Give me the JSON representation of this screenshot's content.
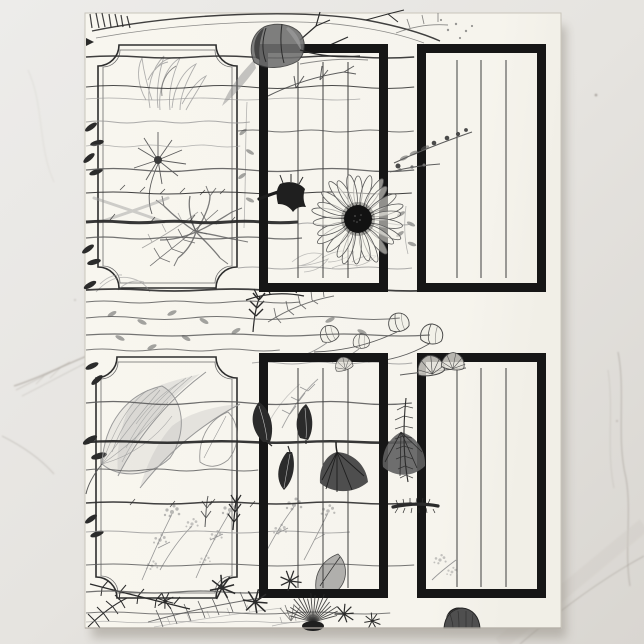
{
  "scene": {
    "type": "product-photo",
    "surface": "white-marble",
    "product": "botanical-journal-page"
  },
  "colors": {
    "marble_base": "#eae8e4",
    "marble_dark": "#d9d6d1",
    "marble_vein": "#a39d95",
    "paper": "#f7f5ee",
    "paper_edge": "#c9c5bb",
    "shadow": "#9a948b",
    "ink": "#161616",
    "ink_dark": "#2b2b2b",
    "sketch_mid": "#5c5c5c",
    "sketch_light": "#979797",
    "rule_line": "#3f3f3f"
  },
  "paper": {
    "x": 85,
    "y": 13,
    "width": 476,
    "height": 615
  },
  "frames": {
    "ornate": [
      {
        "id": "top-left-label",
        "x": 98,
        "y": 45,
        "w": 139,
        "h": 243,
        "r": 21
      },
      {
        "id": "bottom-left-label",
        "x": 96,
        "y": 357,
        "w": 141,
        "h": 241,
        "r": 21
      }
    ],
    "journal": [
      {
        "id": "top-middle",
        "x": 259,
        "y": 44,
        "w": 129,
        "h": 248,
        "stroke": 9,
        "line_xs": [
          298,
          323,
          348
        ],
        "line_y1": 62,
        "line_y2": 278
      },
      {
        "id": "top-right",
        "x": 417,
        "y": 44,
        "w": 129,
        "h": 248,
        "stroke": 9,
        "line_xs": [
          457,
          481,
          506
        ],
        "line_y1": 60,
        "line_y2": 278
      },
      {
        "id": "bottom-middle",
        "x": 259,
        "y": 353,
        "w": 129,
        "h": 245,
        "stroke": 9,
        "line_xs": [
          298,
          323,
          348
        ],
        "line_y1": 368,
        "line_y2": 588
      },
      {
        "id": "bottom-right",
        "x": 417,
        "y": 353,
        "w": 129,
        "h": 245,
        "stroke": 9,
        "line_xs": [
          457,
          481,
          506
        ],
        "line_y1": 368,
        "line_y2": 587
      }
    ]
  },
  "stems": [
    {
      "y": 57,
      "x1": 86,
      "x2": 414,
      "w": 1.5,
      "tone": "dark",
      "amp": 2,
      "o": 0.9
    },
    {
      "y": 87,
      "x1": 86,
      "x2": 414,
      "w": 1.1,
      "tone": "dark",
      "amp": 3,
      "o": 0.85
    },
    {
      "y": 99,
      "x1": 86,
      "x2": 360,
      "w": 0.8,
      "tone": "light",
      "amp": 2,
      "o": 0.8
    },
    {
      "y": 122,
      "x1": 86,
      "x2": 250,
      "w": 0.9,
      "tone": "light",
      "amp": 2,
      "o": 0.8
    },
    {
      "y": 131,
      "x1": 238,
      "x2": 414,
      "w": 1.0,
      "tone": "mid",
      "amp": 2,
      "o": 0.85
    },
    {
      "y": 146,
      "x1": 86,
      "x2": 240,
      "w": 0.8,
      "tone": "light",
      "amp": 2,
      "o": 0.75
    },
    {
      "y": 170,
      "x1": 86,
      "x2": 414,
      "w": 1.3,
      "tone": "mid",
      "amp": 3,
      "o": 0.9
    },
    {
      "y": 193,
      "x1": 86,
      "x2": 412,
      "w": 1.1,
      "tone": "dark",
      "amp": 2,
      "o": 0.9
    },
    {
      "y": 222,
      "x1": 86,
      "x2": 298,
      "w": 3.0,
      "tone": "dark",
      "amp": 1.5,
      "o": 0.95
    },
    {
      "y": 224,
      "x1": 298,
      "x2": 412,
      "w": 0.9,
      "tone": "light",
      "amp": 2,
      "o": 0.8
    },
    {
      "y": 238,
      "x1": 86,
      "x2": 302,
      "w": 1.3,
      "tone": "mid",
      "amp": 2,
      "o": 0.85
    },
    {
      "y": 268,
      "x1": 238,
      "x2": 412,
      "w": 0.9,
      "tone": "light",
      "amp": 2,
      "o": 0.8
    },
    {
      "y": 290,
      "x1": 86,
      "x2": 440,
      "w": 1.7,
      "tone": "dark",
      "amp": 2,
      "o": 0.9
    },
    {
      "y": 302,
      "x1": 86,
      "x2": 300,
      "w": 1.0,
      "tone": "mid",
      "amp": 2,
      "o": 0.85
    },
    {
      "y": 318,
      "x1": 86,
      "x2": 400,
      "w": 1.1,
      "tone": "mid",
      "amp": 3,
      "o": 0.85
    },
    {
      "y": 335,
      "x1": 86,
      "x2": 430,
      "w": 1.2,
      "tone": "mid",
      "amp": 2,
      "o": 0.85
    },
    {
      "y": 350,
      "x1": 86,
      "x2": 280,
      "w": 1.0,
      "tone": "mid",
      "amp": 2,
      "o": 0.8
    },
    {
      "y": 363,
      "x1": 252,
      "x2": 412,
      "w": 0.9,
      "tone": "light",
      "amp": 2,
      "o": 0.8
    },
    {
      "y": 403,
      "x1": 86,
      "x2": 412,
      "w": 1.2,
      "tone": "mid",
      "amp": 3,
      "o": 0.9
    },
    {
      "y": 442,
      "x1": 86,
      "x2": 412,
      "w": 2.6,
      "tone": "dark",
      "amp": 1.5,
      "o": 0.95
    },
    {
      "y": 470,
      "x1": 86,
      "x2": 258,
      "w": 1.0,
      "tone": "mid",
      "amp": 2,
      "o": 0.85
    },
    {
      "y": 503,
      "x1": 86,
      "x2": 412,
      "w": 1.4,
      "tone": "dark",
      "amp": 2,
      "o": 0.9
    },
    {
      "y": 532,
      "x1": 86,
      "x2": 350,
      "w": 0.9,
      "tone": "light",
      "amp": 2,
      "o": 0.8
    },
    {
      "y": 565,
      "x1": 86,
      "x2": 414,
      "w": 1.1,
      "tone": "mid",
      "amp": 2,
      "o": 0.85
    },
    {
      "y": 592,
      "x1": 86,
      "x2": 360,
      "w": 1.2,
      "tone": "mid",
      "amp": 2,
      "o": 0.85
    },
    {
      "y": 613,
      "x1": 86,
      "x2": 390,
      "w": 1.0,
      "tone": "mid",
      "amp": 2,
      "o": 0.8
    },
    {
      "y": 622,
      "x1": 86,
      "x2": 300,
      "w": 0.8,
      "tone": "light",
      "amp": 1.5,
      "o": 0.7
    }
  ],
  "daisy": {
    "cx": 358,
    "cy": 219,
    "disc_r": 14,
    "petals": 26,
    "petal_inner": 13,
    "petal_outer": 43
  },
  "thistle": {
    "cx": 313,
    "cy": 625,
    "rays": 18,
    "radius": 27
  },
  "motifs": [
    "tulip",
    "grass-tuft",
    "wildflower",
    "fern-skeleton",
    "root-branches",
    "bellflower",
    "daisy",
    "berry-sprig",
    "cup-buds",
    "fan-poppy-buds",
    "feather-leaves",
    "large-leaf",
    "rose-leaves",
    "poppy-blooms",
    "gypsophila",
    "star-flowers",
    "grass-spike",
    "fern-fronds",
    "thistle-fluff",
    "mushroom",
    "feather-plume",
    "caterpillar-stem"
  ]
}
